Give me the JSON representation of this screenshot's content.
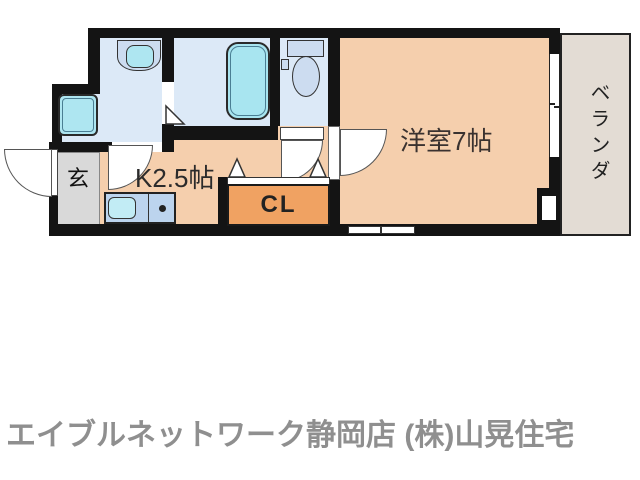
{
  "floorplan": {
    "rooms": {
      "entrance": {
        "label": "玄"
      },
      "kitchen": {
        "label": "K2.5帖"
      },
      "closet": {
        "label": "CL"
      },
      "western_room": {
        "label": "洋室7帖"
      },
      "veranda": {
        "label": "ベランダ"
      }
    },
    "fixtures": [
      "bathtub",
      "toilet",
      "wash-basin",
      "washing-machine-pan",
      "kitchen-sink",
      "gas-burner"
    ],
    "colors": {
      "wall": "#141414",
      "floor_peach": "#f5cfad",
      "closet_orange": "#f0a262",
      "wet_area_blue": "#dce9f7",
      "fixture_cyan": "#aee6f1",
      "fixture_blue_gray": "#ccdcf0",
      "kitchen_counter_blue": "#bcd4ee",
      "entrance_gray": "#d9d9d9",
      "veranda_beige": "#e3dcd4",
      "caption_gray": "#8f8f8f"
    }
  },
  "caption": {
    "text": "エイブルネットワーク静岡店 (株)山晃住宅"
  }
}
